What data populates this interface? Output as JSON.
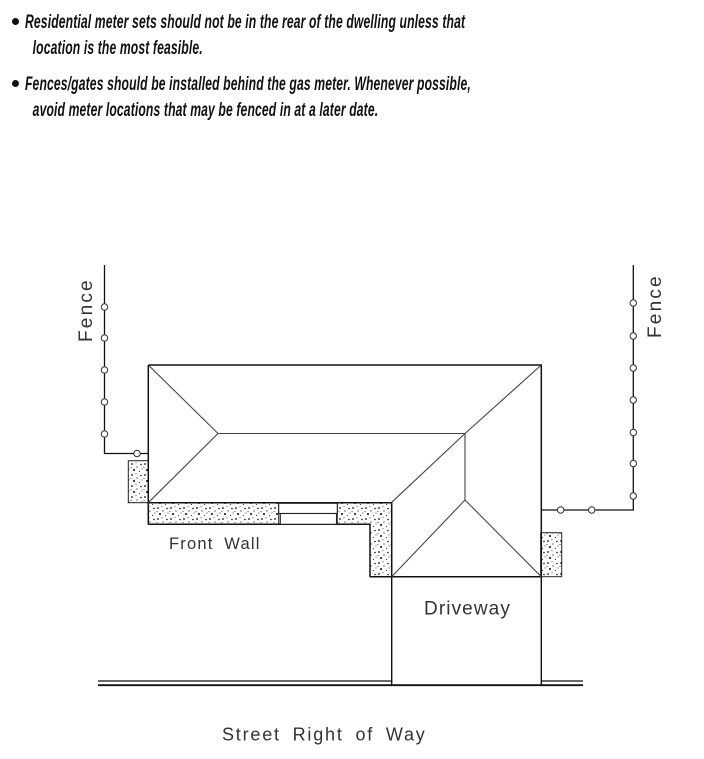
{
  "bullets": [
    {
      "lines": [
        "Residential meter sets should not be in the rear of the dwelling unless that",
        "location is the most feasible."
      ]
    },
    {
      "lines": [
        "Fences/gates should be installed behind the gas meter. Whenever possible,",
        "avoid meter locations that may be fenced in at a later date."
      ]
    }
  ],
  "diagram": {
    "labels": {
      "fence_left": "Fence",
      "fence_right": "Fence",
      "front_wall": "Front Wall",
      "driveway": "Driveway",
      "street": "Street Right of Way"
    },
    "colors": {
      "wall_line": "#111111",
      "roof_line": "#444444",
      "label_text": "#333333",
      "stipple_dot": "#111111",
      "background": "#ffffff"
    }
  }
}
